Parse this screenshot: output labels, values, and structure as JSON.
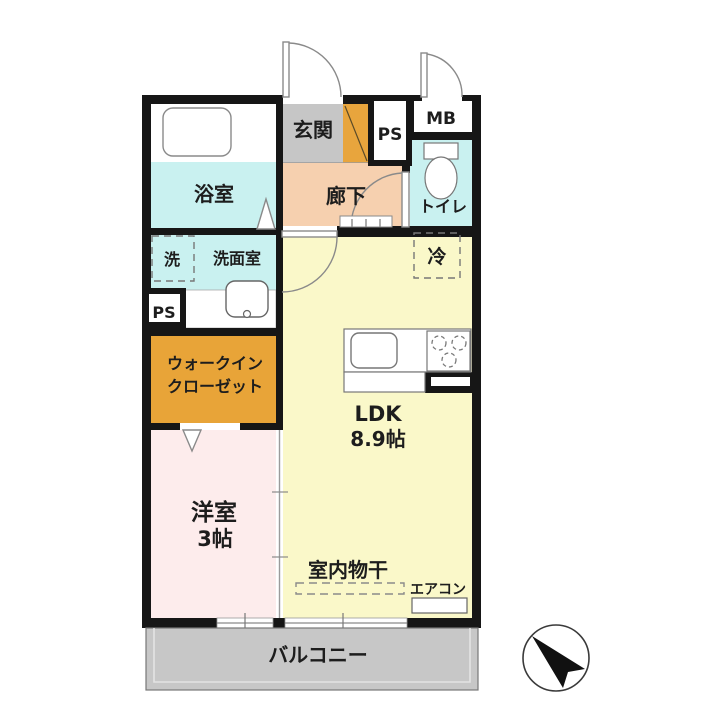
{
  "colors": {
    "wall": "#161616",
    "water_cyan": "#c9f1f0",
    "entry_gray": "#c6c6c6",
    "shoe_cabinet_orange": "#e8a53d",
    "hallway_peach": "#f6d0af",
    "ldk_yellow": "#faf8c9",
    "bedroom_pink": "#fdecec",
    "wic_orange": "#e8a438",
    "balcony_gray": "#c7c7c7",
    "fixture_white": "#ffffff",
    "text_dark": "#1d1d1d",
    "compass_needle": "#111111"
  },
  "rooms": {
    "entrance": {
      "label": "玄関"
    },
    "hallway": {
      "label": "廊下"
    },
    "bathroom": {
      "label": "浴室"
    },
    "washroom": {
      "label": "洗面室"
    },
    "washer_space": {
      "label": "洗"
    },
    "pipe_space_top": {
      "label": "PS"
    },
    "pipe_space_side": {
      "label": "PS"
    },
    "meter_box": {
      "label": "MB"
    },
    "toilet": {
      "label": "トイレ"
    },
    "fridge_space": {
      "label": "冷"
    },
    "walk_in_closet": {
      "label_line1": "ウォークイン",
      "label_line2": "クローゼット"
    },
    "ldk": {
      "label": "LDK",
      "size": "8.9帖"
    },
    "western_room": {
      "label": "洋室",
      "size": "3帖"
    },
    "indoor_drying": {
      "label": "室内物干"
    },
    "aircon": {
      "label": "エアコン"
    },
    "balcony": {
      "label": "バルコニー"
    }
  }
}
